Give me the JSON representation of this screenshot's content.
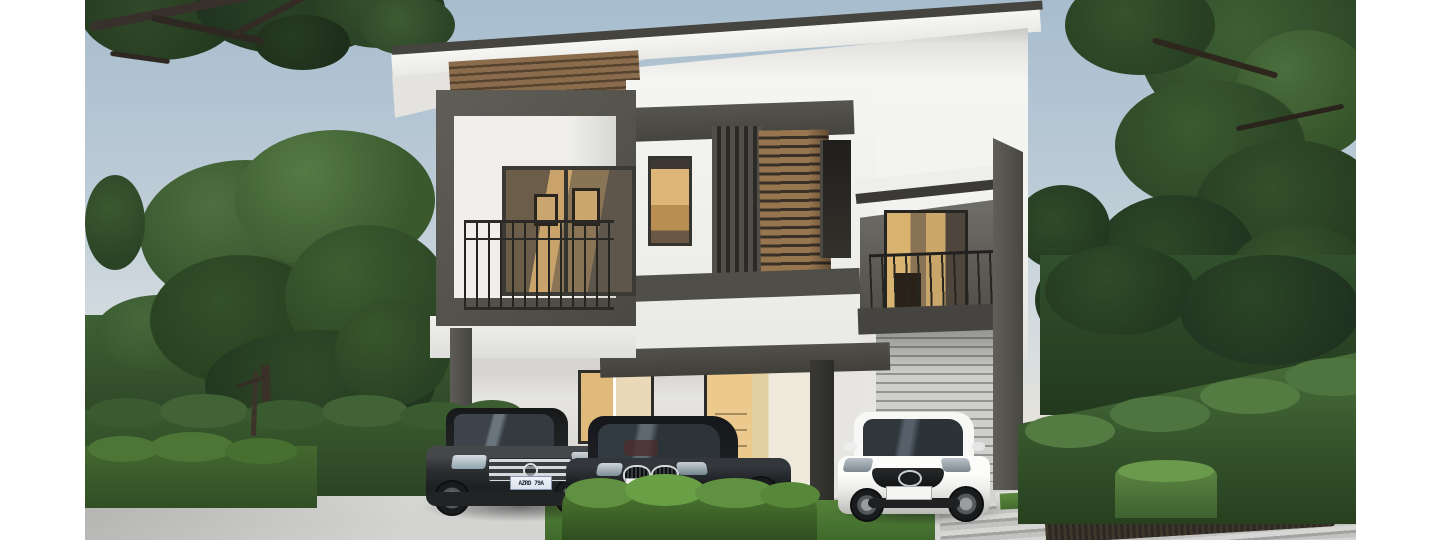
{
  "image": {
    "kind": "architectural-rendering",
    "subject": "Modern two-story house with carport, roller garage door and three parked cars, framed by trees and hedges",
    "margins": "white bars on far left and right edges"
  },
  "palette": {
    "sky_top": "#a7bdce",
    "sky_horizon": "#e5e3dd",
    "wall_white": "#f5f5f3",
    "charcoal_trim": "#55524c",
    "wood_slat": "#8d6f4f",
    "warm_window_light": "#dcb577",
    "garage_door_gray": "#c4c5c2",
    "driveway_gray": "#c9cac7",
    "foliage_dark": "#2c4526",
    "foliage_light": "#5a7d48",
    "bush_bright": "#4f7c33"
  },
  "house": {
    "style": "modern two-story",
    "features": [
      "flat overhanging roof",
      "horizontal wood slat cladding",
      "boxed balcony with dark metal railing",
      "vertical louver screen",
      "second balcony above garage",
      "carport with warm-lit sliding door",
      "gray roller garage door",
      "tall charcoal parapet wall"
    ]
  },
  "cars": [
    {
      "name": "dark gray sedan",
      "emblem": "mercedes-star",
      "plate": "AZRD 79A"
    },
    {
      "name": "black coupe",
      "emblem": "bmw-kidney-grille",
      "plate": "EVERMOTION"
    },
    {
      "name": "white sedan",
      "emblem": "mazda-wing",
      "plate": ""
    }
  ],
  "vegetation": {
    "left": [
      "overhanging branch, top-left",
      "large green tree",
      "background trees",
      "two-tier trimmed hedge",
      "small tree trunk in hedge"
    ],
    "right": [
      "tall dense trees",
      "sloping tall hedge",
      "trimmed hedge box"
    ],
    "center": [
      "bright low bush on grass in front of cars"
    ]
  },
  "ground": {
    "items": [
      "light concrete driveway",
      "slatted paver walkway (bottom right)",
      "dark soil planting bed",
      "light curb step",
      "grass strips"
    ]
  }
}
